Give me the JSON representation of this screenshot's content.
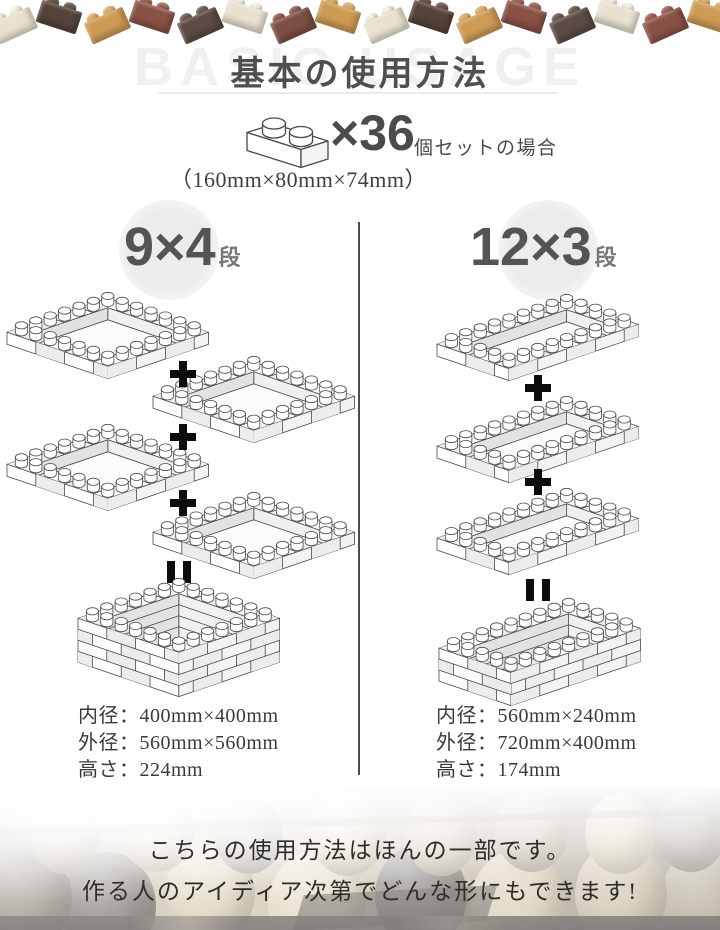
{
  "header": {
    "watermark": "BASIC USAGE",
    "title": "基本の使用方法"
  },
  "set_info": {
    "count_label": "×36",
    "count_suffix": "個セットの場合",
    "brick_dimensions": "（160mm×80mm×74mm）"
  },
  "top_border": {
    "bricks": [
      {
        "body": "#E8E2CF",
        "stud": "#F4EFDE"
      },
      {
        "body": "#55433A",
        "stud": "#6B564B"
      },
      {
        "body": "#CE9B55",
        "stud": "#DDAF6C"
      },
      {
        "body": "#8A5247",
        "stud": "#9D6458"
      },
      {
        "body": "#5C4A45",
        "stud": "#705C55"
      },
      {
        "body": "#E8E2CF",
        "stud": "#F4EFDE"
      },
      {
        "body": "#7D4F43",
        "stud": "#916055"
      },
      {
        "body": "#CE9B55",
        "stud": "#DDAF6C"
      },
      {
        "body": "#E8E2CF",
        "stud": "#F4EFDE"
      },
      {
        "body": "#55433A",
        "stud": "#6B564B"
      },
      {
        "body": "#CE9B55",
        "stud": "#DDAF6C"
      },
      {
        "body": "#8A5247",
        "stud": "#9D6458"
      },
      {
        "body": "#5C4A45",
        "stud": "#705C55"
      },
      {
        "body": "#E8E2CF",
        "stud": "#F4EFDE"
      },
      {
        "body": "#8A5247",
        "stud": "#9D6458"
      },
      {
        "body": "#CE9B55",
        "stud": "#DDAF6C"
      }
    ]
  },
  "columns": [
    {
      "id": "left",
      "label_number": "9×4",
      "label_unit": "段",
      "diagram": {
        "tiers": 4,
        "plan": "square",
        "zigzag": true
      },
      "specs": [
        "内径：400mm×400mm",
        "外径：560mm×560mm",
        "高さ：224mm"
      ]
    },
    {
      "id": "right",
      "label_number": "12×3",
      "label_unit": "段",
      "diagram": {
        "tiers": 3,
        "plan": "rectangle",
        "zigzag": false
      },
      "specs": [
        "内径：560mm×240mm",
        "外径：720mm×400mm",
        "高さ：174mm"
      ]
    }
  ],
  "operators": {
    "plus": "+",
    "equals": "="
  },
  "footer": {
    "line1": "こちらの使用方法はほんの一部です。",
    "line2": "作る人のアイディア次第でどんな形にもできます!"
  },
  "colors": {
    "divider": "#4c4c4c",
    "title_text": "#4f4f4f",
    "watermark_text": "#F1F0EE",
    "header_number": "#545356",
    "spec_text": "#3A3A3A",
    "diagram_stroke": "#4a4a4a",
    "operator": "#0d0d0d"
  }
}
